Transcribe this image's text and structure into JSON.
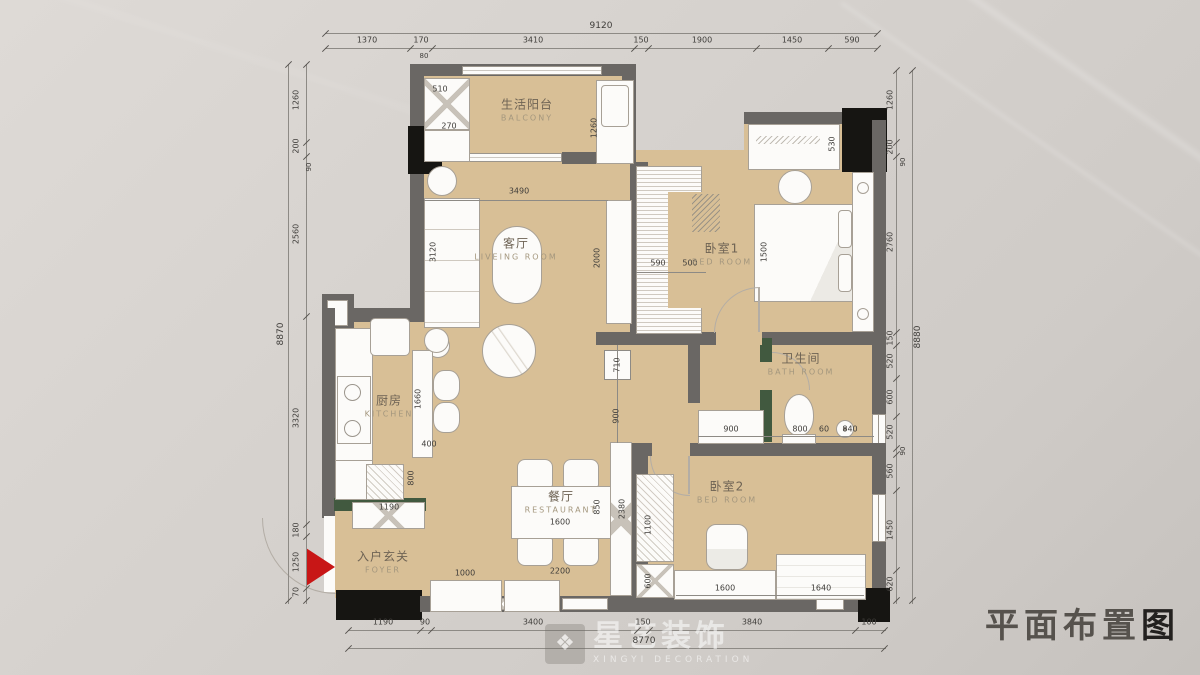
{
  "title": {
    "main": "平面布置",
    "last": "图"
  },
  "watermark": {
    "name": "星艺装饰",
    "sub": "XINGYI DECORATION",
    "logo_glyph": "❖"
  },
  "rooms": [
    {
      "id": "balcony",
      "cn": "生活阳台",
      "en": "BALCONY"
    },
    {
      "id": "living",
      "cn": "客厅",
      "en": "LIVEING ROOM"
    },
    {
      "id": "bedroom1",
      "cn": "卧室1",
      "en": "BED ROOM"
    },
    {
      "id": "kitchen",
      "cn": "厨房",
      "en": "KITCHEN"
    },
    {
      "id": "dining",
      "cn": "餐厅",
      "en": "RESTAURANT"
    },
    {
      "id": "foyer",
      "cn": "入户玄关",
      "en": "FOYER"
    },
    {
      "id": "bathroom",
      "cn": "卫生间",
      "en": "BATH ROOM"
    },
    {
      "id": "bedroom2",
      "cn": "卧室2",
      "en": "BED ROOM"
    }
  ],
  "dims": {
    "top": {
      "overall": "9120",
      "segments": [
        "1370",
        "170",
        "3410",
        "150",
        "1900",
        "1450",
        "590"
      ],
      "sub": "80"
    },
    "left": {
      "overall": "8870",
      "segments": [
        "1260",
        "200",
        "90",
        "2560",
        "3320",
        "180",
        "1250",
        "70"
      ]
    },
    "right": {
      "overall": "8880",
      "segments": [
        "1260",
        "200",
        "90",
        "2760",
        "150",
        "520",
        "600",
        "520",
        "90",
        "560",
        "1450",
        "620"
      ]
    },
    "bottom": {
      "overall": "8770",
      "segments": [
        "1190",
        "90",
        "3400",
        "150",
        "3840",
        "100"
      ]
    },
    "interior": [
      "510",
      "270",
      "1260",
      "3490",
      "3120",
      "2000",
      "530",
      "590",
      "500",
      "1500",
      "1660",
      "400",
      "800",
      "1190",
      "710",
      "900",
      "900",
      "800",
      "60",
      "840",
      "850",
      "1600",
      "2380",
      "2200",
      "1000",
      "1100",
      "600",
      "1600",
      "1640"
    ]
  },
  "colors": {
    "floor": "#d8bf96",
    "wall": "#6a6764",
    "column": "#161512",
    "green": "#41593f",
    "entry_arrow": "#c81616",
    "background": "#d6d2ce"
  }
}
